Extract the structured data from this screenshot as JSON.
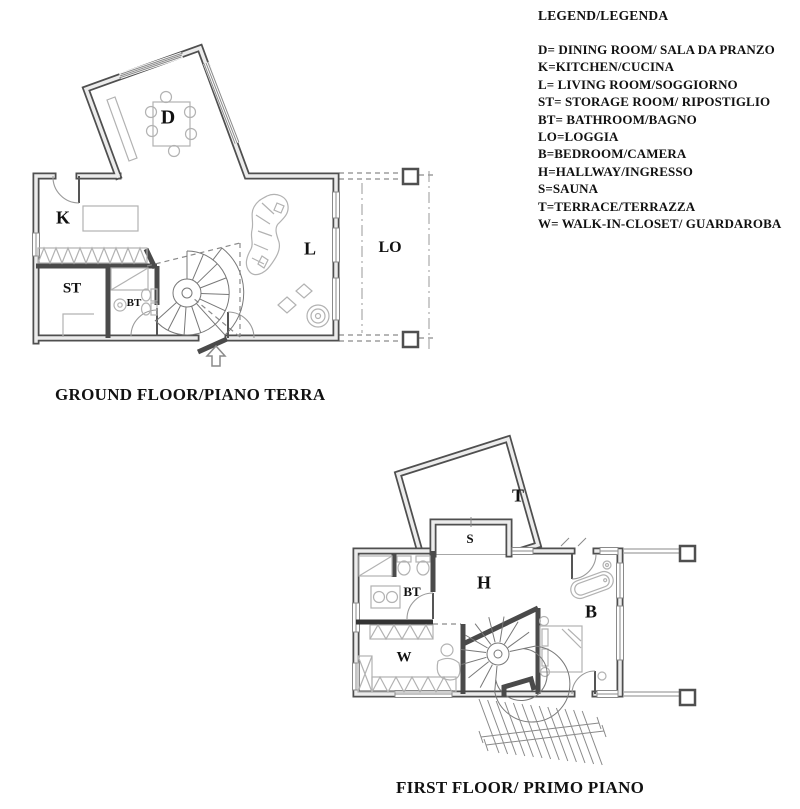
{
  "legend": {
    "title": "LEGEND/LEGENDA",
    "items": [
      "D= DINING ROOM/ SALA DA PRANZO",
      "K=KITCHEN/CUCINA",
      "L= LIVING ROOM/SOGGIORNO",
      "ST= STORAGE ROOM/ RIPOSTIGLIO",
      "BT= BATHROOM/BAGNO",
      "LO=LOGGIA",
      "B=BEDROOM/CAMERA",
      "H=HALLWAY/INGRESSO",
      "S=SAUNA",
      "T=TERRACE/TERRAZZA",
      "W= WALK-IN-CLOSET/ GUARDAROBA"
    ]
  },
  "ground_floor": {
    "title": "GROUND FLOOR/PIANO TERRA",
    "labels": {
      "dining": "D",
      "kitchen": "K",
      "living": "L",
      "storage": "ST",
      "bathroom": "BT",
      "loggia": "LO"
    }
  },
  "first_floor": {
    "title": "FIRST FLOOR/ PRIMO PIANO",
    "labels": {
      "terrace": "T",
      "sauna": "S",
      "hallway": "H",
      "bathroom": "BT",
      "bedroom": "B",
      "walk_in_closet": "W"
    }
  },
  "colors": {
    "wall": "#4f4f4f",
    "wall_core": "#ececec",
    "furniture": "#b2b2b2",
    "dashed_lines": "#8a8a8a",
    "text": "#111111",
    "background": "#ffffff"
  }
}
